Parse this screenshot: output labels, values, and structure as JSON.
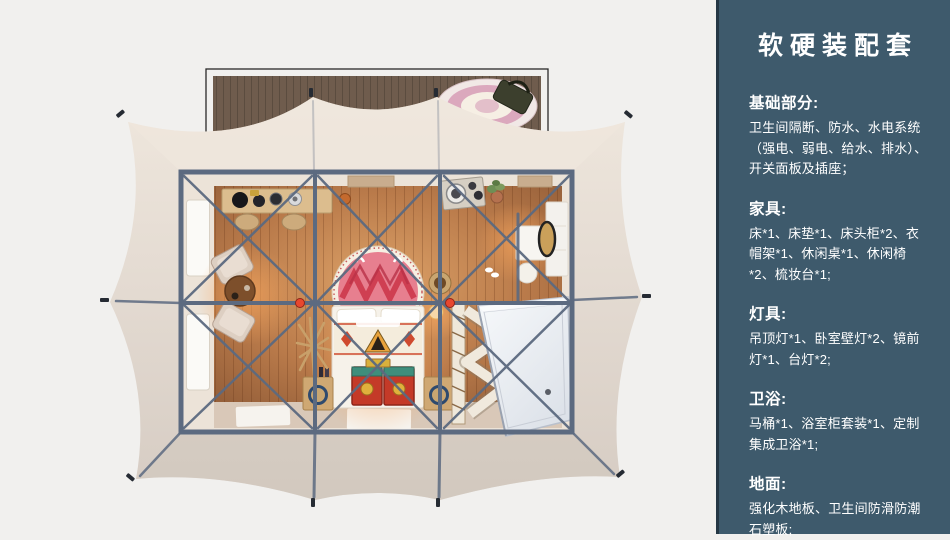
{
  "sidebar": {
    "title": "软硬装配套",
    "sections": [
      {
        "heading": "基础部分:",
        "body": "卫生间隔断、防水、水电系统（强电、弱电、给水、排水）、开关面板及插座；"
      },
      {
        "heading": "家具:",
        "body": "床*1、床垫*1、床头柜*2、衣帽架*1、休闲桌*1、休闲椅*2、梳妆台*1;"
      },
      {
        "heading": "灯具:",
        "body": "吊顶灯*1、卧室壁灯*2、镜前灯*1、台灯*2;"
      },
      {
        "heading": "卫浴:",
        "body": "马桶*1、浴室柜套装*1、定制集成卫浴*1;"
      },
      {
        "heading": "地面:",
        "body": "强化木地板、卫生间防滑防潮石塑板;"
      }
    ]
  },
  "colors": {
    "page_bg": "#f1f0ee",
    "sidebar_bg": "#3e5a6c",
    "sidebar_border": "#253744",
    "sidebar_text": "#ffffff",
    "tarp": "#e4dbd2",
    "tarp_light": "#efe7dd",
    "tarp_dark": "#d6ccc3",
    "deck_wood": "#6f5c4d",
    "deck_frame": "#2a2a28",
    "floor_wood": "#b97a4a",
    "floor_wood_light": "#dda268",
    "floor_wood_dark": "#96603a",
    "wall_cream": "#ece3d8",
    "bottom_strip": "#d9c8b8",
    "frame_steel": "#5c6a80",
    "joint_red": "#e8472e",
    "bed_white": "#f6f2ea",
    "mandala_pink": "#e77f8f",
    "mandala_red": "#cf3f52",
    "chest_red": "#c43a28",
    "wood_furniture": "#cfa873",
    "pod_white": "#eef1f5",
    "pod_edge": "#b9c0cc",
    "mat_white": "#f6f3ee",
    "glow_orange": "#f5a45c",
    "rug_pink": "#dba8bd",
    "bag_olive": "#3c3f2d",
    "cushion_beige": "#ddcfc2",
    "window_white": "#fbfaf7",
    "vent_tan": "#c9ad8e"
  }
}
